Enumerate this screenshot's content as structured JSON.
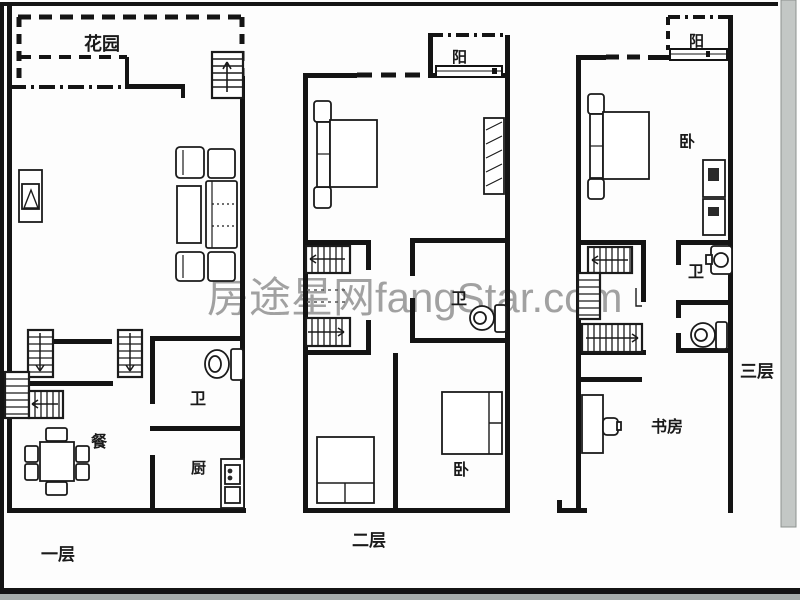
{
  "watermark": {
    "text": "房途星网fangStar.com"
  },
  "colors": {
    "wall": "#141414",
    "background": "#fdfdfd",
    "watermark_gray": "#8f8f8f",
    "edge_bar_gray": "#c3c7c5",
    "bottom_strip_gray": "#a6adab"
  },
  "floors": [
    {
      "label": "一层",
      "garden": "花园",
      "bath": "卫",
      "dining": "餐",
      "kitchen": "厨"
    },
    {
      "label": "二层",
      "balcony": "阳",
      "bath": "卫",
      "bedroom": "卧"
    },
    {
      "label": "三层",
      "balcony": "阳",
      "bedroom": "卧",
      "bath": "卫",
      "study": "书房"
    }
  ]
}
